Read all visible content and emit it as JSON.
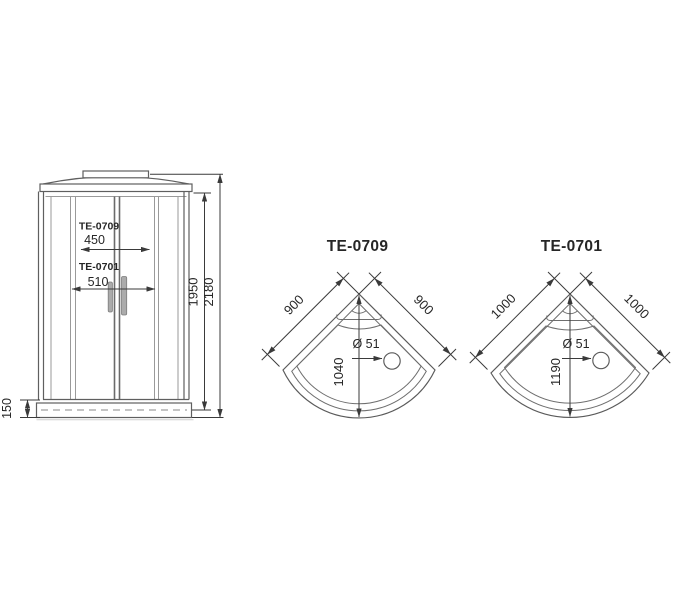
{
  "colors": {
    "line_dark": "#3a3a3a",
    "line_medium": "#5f5f5f",
    "line_light": "#9a9a9a",
    "text": "#262626",
    "handle_fill": "#ababab",
    "background": "#ffffff"
  },
  "front_view": {
    "door_dims": [
      {
        "model": "TE-0709",
        "width": "450"
      },
      {
        "model": "TE-0701",
        "width": "510"
      }
    ],
    "inner_height": "1950",
    "total_height": "2180",
    "tray_height": "150"
  },
  "top_views": [
    {
      "title": "TE-0709",
      "side_left": "900",
      "side_right": "900",
      "depth": "1040",
      "drain": "Ø 51"
    },
    {
      "title": "TE-0701",
      "side_left": "1000",
      "side_right": "1000",
      "depth": "1190",
      "drain": "Ø 51"
    }
  ]
}
